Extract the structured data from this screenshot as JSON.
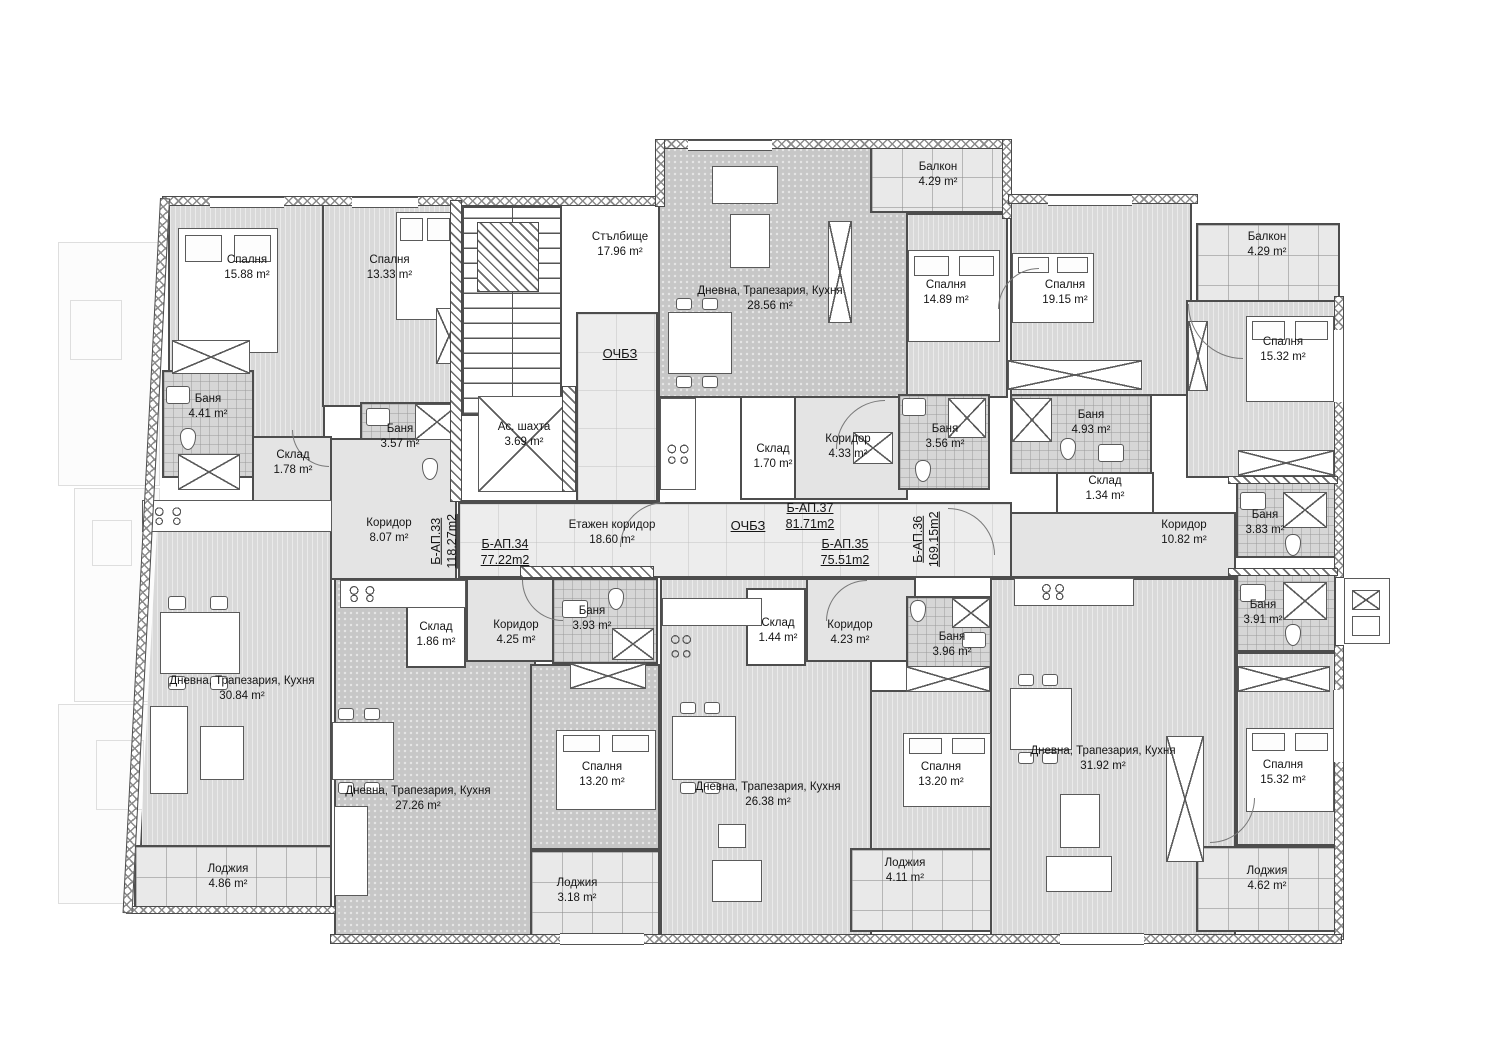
{
  "drawing": {
    "type": "apartment building floor plan",
    "common_areas": {
      "stairwell": {
        "name": "Стълбище",
        "area": "17.96 m²"
      },
      "elevator_shaft": {
        "name": "Ас. шахта",
        "area": "3.69 m²"
      },
      "floor_corridor": {
        "name": "Етажен коридор",
        "area": "18.60 m²"
      },
      "zone_label_left": "ОЧБЗ",
      "zone_label_center": "ОЧБЗ"
    },
    "apartments": [
      {
        "id": "Б-АП.33",
        "total_area": "118.27m2",
        "rooms": [
          {
            "name": "Спалня",
            "area": "15.88 m²"
          },
          {
            "name": "Спалня",
            "area": "13.33 m²"
          },
          {
            "name": "Баня",
            "area": "4.41 m²"
          },
          {
            "name": "Баня",
            "area": "3.57 m²"
          },
          {
            "name": "Склад",
            "area": "1.78 m²"
          },
          {
            "name": "Коридор",
            "area": "8.07 m²"
          },
          {
            "name": "Дневна, Трапезария, Кухня",
            "area": "30.84 m²"
          },
          {
            "name": "Лоджия",
            "area": "4.86 m²"
          }
        ]
      },
      {
        "id": "Б-АП.34",
        "total_area": "77.22m2",
        "rooms": [
          {
            "name": "Склад",
            "area": "1.86 m²"
          },
          {
            "name": "Коридор",
            "area": "4.25 m²"
          },
          {
            "name": "Баня",
            "area": "3.93 m²"
          },
          {
            "name": "Спалня",
            "area": "13.20 m²"
          },
          {
            "name": "Дневна, Трапезария, Кухня",
            "area": "27.26 m²"
          },
          {
            "name": "Лоджия",
            "area": "3.18 m²"
          }
        ]
      },
      {
        "id": "Б-АП.35",
        "total_area": "75.51m2",
        "rooms": [
          {
            "name": "Склад",
            "area": "1.44 m²"
          },
          {
            "name": "Коридор",
            "area": "4.23 m²"
          },
          {
            "name": "Баня",
            "area": "3.96 m²"
          },
          {
            "name": "Спалня",
            "area": "13.20 m²"
          },
          {
            "name": "Дневна, Трапезария, Кухня",
            "area": "26.38 m²"
          },
          {
            "name": "Лоджия",
            "area": "4.11 m²"
          }
        ]
      },
      {
        "id": "Б-АП.36",
        "total_area": "169.15m2",
        "rooms": [
          {
            "name": "Спалня",
            "area": "19.15 m²"
          },
          {
            "name": "Балкон",
            "area": "4.29 m²"
          },
          {
            "name": "Спалня",
            "area": "15.32 m²"
          },
          {
            "name": "Баня",
            "area": "4.93 m²"
          },
          {
            "name": "Склад",
            "area": "1.34 m²"
          },
          {
            "name": "Коридор",
            "area": "10.82 m²"
          },
          {
            "name": "Баня",
            "area": "3.83 m²"
          },
          {
            "name": "Баня",
            "area": "3.91 m²"
          },
          {
            "name": "Дневна, Трапезария, Кухня",
            "area": "31.92 m²"
          },
          {
            "name": "Спалня",
            "area": "15.32 m²"
          },
          {
            "name": "Лоджия",
            "area": "4.62 m²"
          }
        ]
      },
      {
        "id": "Б-АП.37",
        "total_area": "81.71m2",
        "rooms": [
          {
            "name": "Дневна, Трапезария, Кухня",
            "area": "28.56 m²"
          },
          {
            "name": "Балкон",
            "area": "4.29 m²"
          },
          {
            "name": "Спалня",
            "area": "14.89 m²"
          },
          {
            "name": "Коридор",
            "area": "4.33 m²"
          },
          {
            "name": "Склад",
            "area": "1.70 m²"
          },
          {
            "name": "Баня",
            "area": "3.56 m²"
          }
        ]
      }
    ],
    "colors": {
      "wall": "#4a4a4a",
      "room_fill": "#d9d9d9",
      "dark_fill": "#c7c7c7",
      "corridor_fill": "#ededed",
      "background": "#ffffff"
    }
  }
}
